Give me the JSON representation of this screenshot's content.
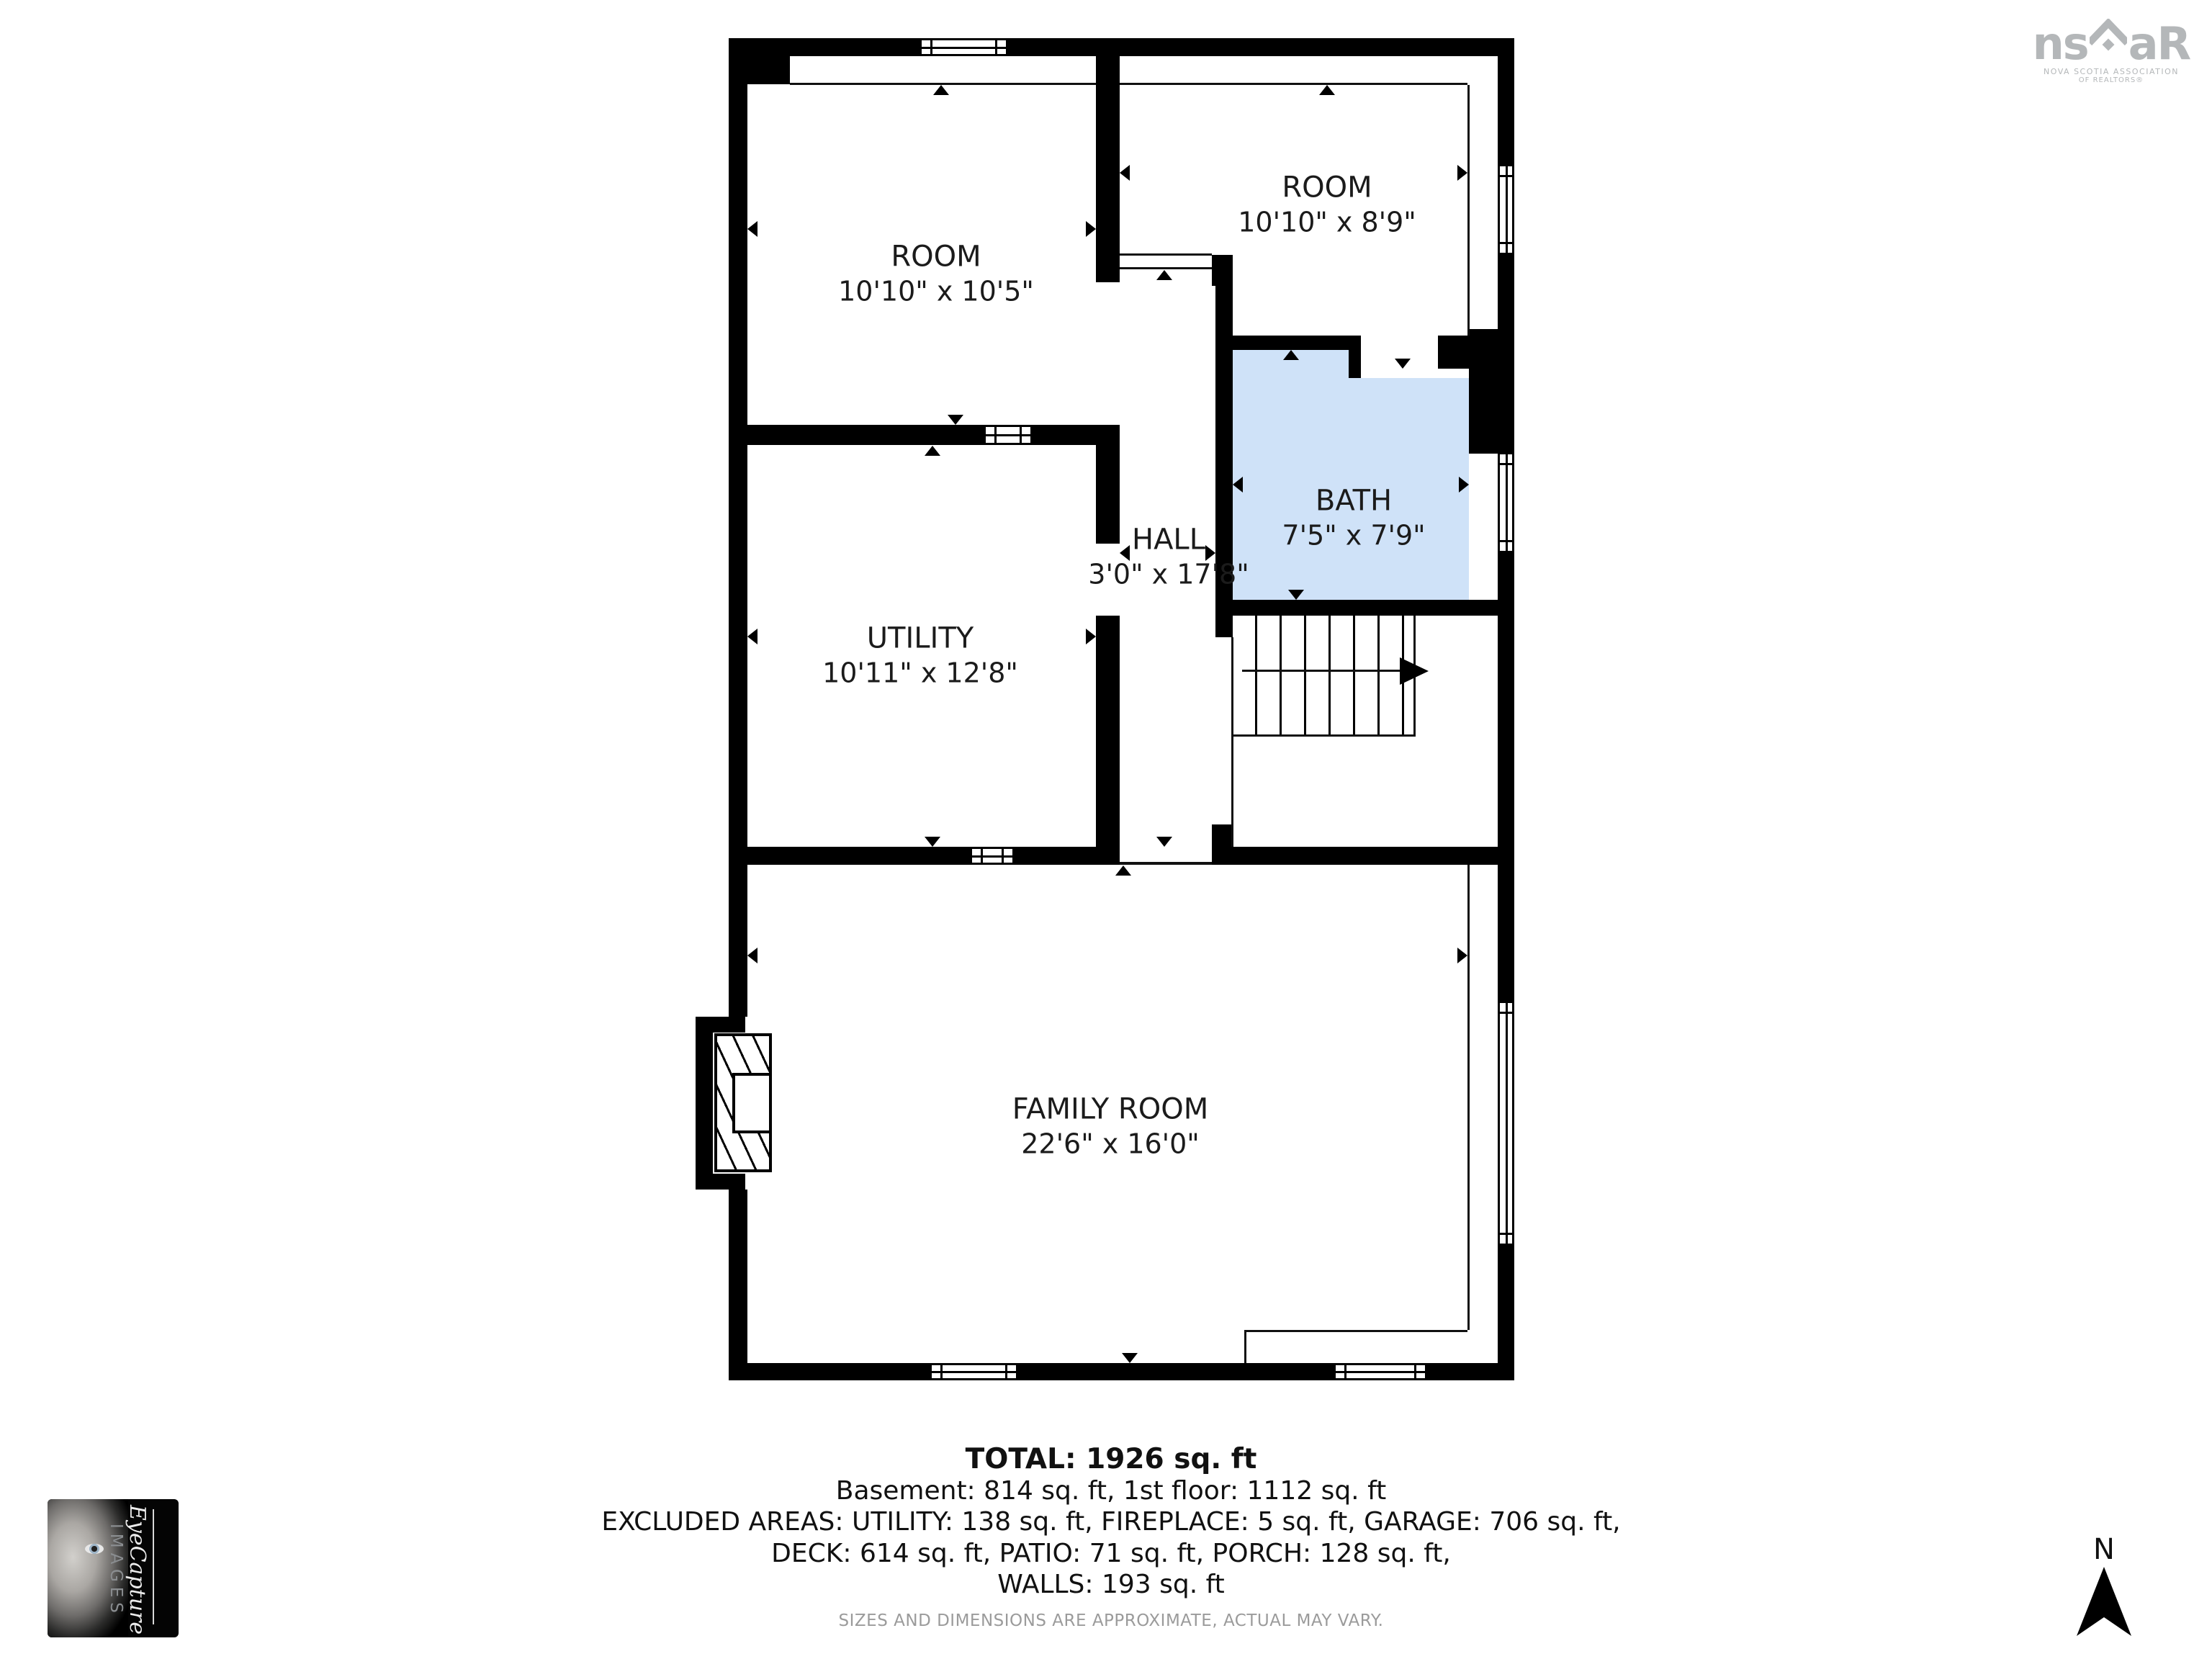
{
  "floorplan": {
    "rooms": [
      {
        "name": "ROOM",
        "dims": "10'10\" x 10'5\""
      },
      {
        "name": "ROOM",
        "dims": "10'10\" x 8'9\""
      },
      {
        "name": "HALL",
        "dims": "3'0\" x 17'8\""
      },
      {
        "name": "BATH",
        "dims": "7'5\" x 7'9\""
      },
      {
        "name": "UTILITY",
        "dims": "10'11\" x 12'8\""
      },
      {
        "name": "FAMILY ROOM",
        "dims": "22'6\" x 16'0\""
      }
    ],
    "colors": {
      "bath": "#cfe2f8",
      "walls": "#000000"
    }
  },
  "summary": {
    "total": "TOTAL: 1926 sq. ft",
    "line1": "Basement: 814 sq. ft, 1st floor: 1112 sq. ft",
    "line2": "EXCLUDED AREAS: UTILITY: 138 sq. ft, FIREPLACE: 5 sq. ft, GARAGE: 706 sq. ft,",
    "line3": "DECK: 614 sq. ft, PATIO: 71 sq. ft, PORCH: 128 sq. ft,",
    "line4": "WALLS: 193 sq. ft",
    "disclaimer": "SIZES AND DIMENSIONS ARE APPROXIMATE, ACTUAL MAY VARY."
  },
  "branding": {
    "nsar": {
      "big_ns": "ns",
      "big_ar": "aR",
      "sub1": "NOVA SCOTIA ASSOCIATION",
      "sub2": "OF REALTORS®"
    },
    "eyecapture": {
      "script": "EyeCapture",
      "caps": "IMAGES"
    }
  },
  "compass": {
    "north": "N"
  }
}
